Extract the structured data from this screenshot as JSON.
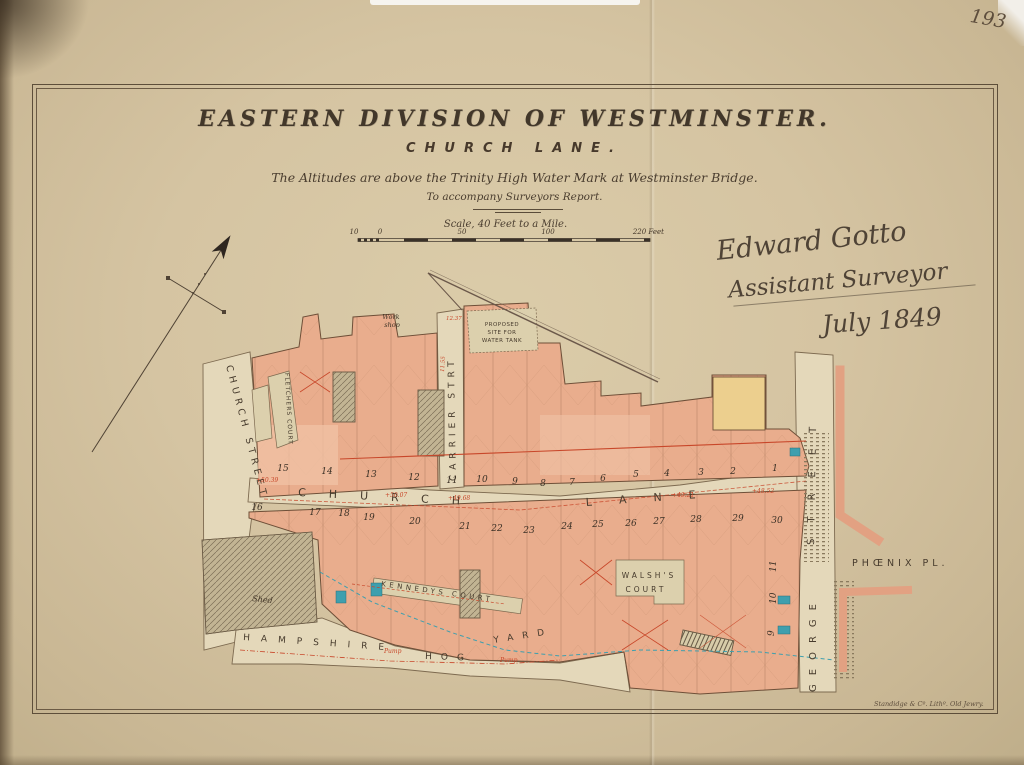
{
  "page": {
    "page_number": "193",
    "imprint": "Standidge & Cº. Lithº. Old Jewry.",
    "colors": {
      "paper": "#d5c4a2",
      "ink": "#3e3326",
      "building_salmon": "#e9ad8d",
      "street_cream": "#e4d8ba",
      "accent_red": "#c8472a",
      "cistern_teal": "#3e9fae",
      "yellow_block": "#eccf8e"
    }
  },
  "title_block": {
    "title": "EASTERN DIVISION OF WESTMINSTER.",
    "subtitle": "CHURCH LANE.",
    "note1": "The Altitudes are above the Trinity High Water Mark at Westminster Bridge.",
    "note2": "To accompany Surveyors Report.",
    "scale_label": "Scale, 40 Feet to a Mile.",
    "scale_ticks": [
      "10",
      "0",
      "50",
      "100",
      "220 Feet"
    ]
  },
  "signature": {
    "line1": "Edward Gotto",
    "line2": "Assistant Surveyor",
    "line3": "July 1849"
  },
  "map": {
    "streets": {
      "church_street": "CHURCH STREET",
      "carrier_street": "CARRIER STRT",
      "church_lane_a": "CHURCH",
      "church_lane_b": "LANE",
      "george_street_a": "GEORGE",
      "george_street_b": "STREET",
      "phoenix_place": "PHŒNIX PL.",
      "hampshire_a": "HAMPSHIRE",
      "hampshire_b": "HOG",
      "hampshire_c": "YARD"
    },
    "courts": {
      "fletchers": "FLETCHERS COURT",
      "kennedys": "KENNEDYS COURT",
      "walshs_line1": "WALSH'S",
      "walshs_line2": "COURT",
      "proposed_line1": "PROPOSED",
      "proposed_line2": "SITE FOR",
      "proposed_line3": "WATER TANK"
    },
    "labels": {
      "work_shop_line1": "Work",
      "work_shop_line2": "shop",
      "shed": "Shed",
      "pump": "Pump"
    },
    "house_numbers_north": [
      "15",
      "14",
      "13",
      "12",
      "11",
      "10",
      "9",
      "8",
      "7",
      "6",
      "5",
      "4",
      "3",
      "2",
      "1"
    ],
    "house_numbers_south": [
      "16",
      "17",
      "18",
      "19",
      "20",
      "21",
      "22",
      "23",
      "24",
      "25",
      "26",
      "27",
      "28",
      "29",
      "30"
    ],
    "side_numbers": [
      "11",
      "10",
      "9"
    ],
    "altitudes": [
      "+50.39",
      "+50.07",
      "+49.68",
      "+49.21",
      "+48.52"
    ],
    "survey_marks": [
      "12.37",
      "11.55"
    ]
  }
}
